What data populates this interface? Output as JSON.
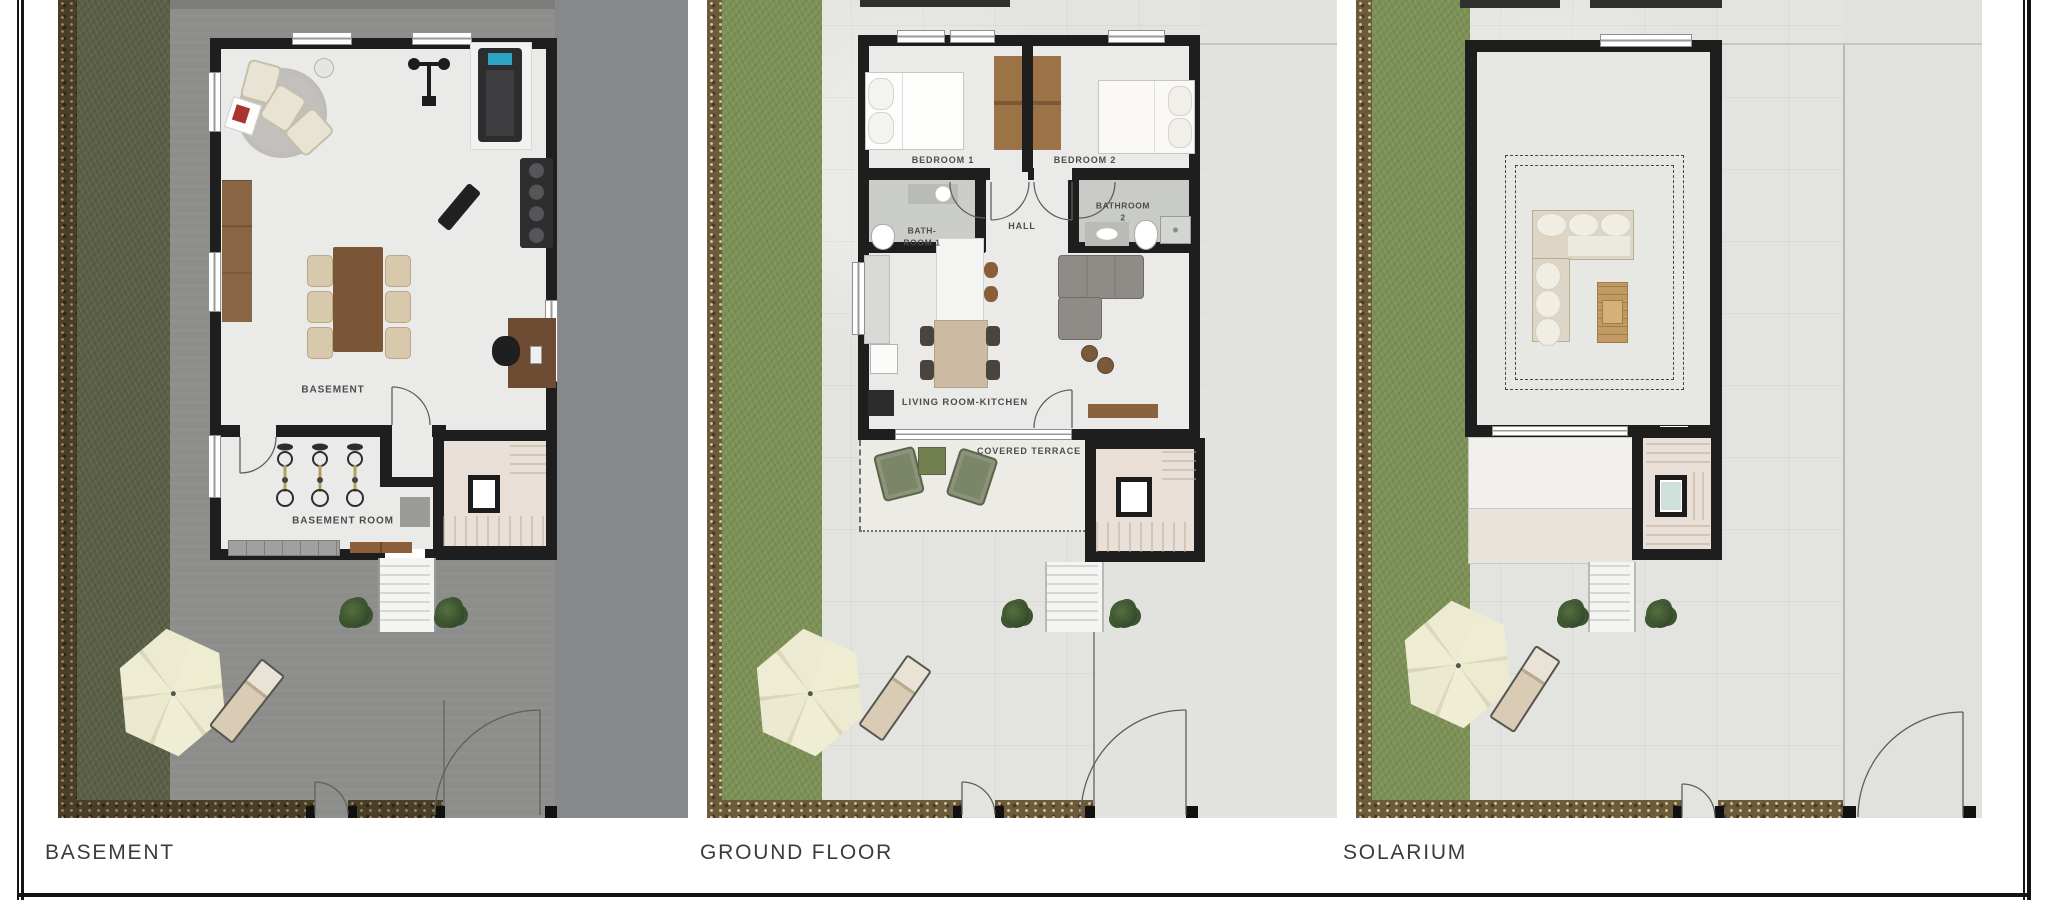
{
  "document": {
    "type": "architectural floor plan sheet",
    "sheet_background": "#ffffff"
  },
  "plans": {
    "basement": {
      "title": "BASEMENT",
      "rooms": {
        "main": "BASEMENT",
        "storage": "BASEMENT ROOM"
      }
    },
    "ground_floor": {
      "title": "GROUND FLOOR",
      "rooms": {
        "bedroom1": "BEDROOM 1",
        "bedroom2": "BEDROOM 2",
        "bath1_l1": "BATH-",
        "bath1_l2": "ROOM 1",
        "bath2_l1": "BATHROOM",
        "bath2_l2": "2",
        "hall": "HALL",
        "living": "LIVING ROOM-KITCHEN",
        "terrace": "COVERED TERRACE"
      }
    },
    "solarium": {
      "title": "SOLARIUM",
      "rooms": {}
    }
  },
  "palette": {
    "wall_black": "#1e1e1e",
    "basement_concrete": "#8d8d8b",
    "basement_garden_grass": "#5a5f45",
    "garden_grass": "#7d9156",
    "dirt_border": "#6b5b39",
    "paving_light": "#e3e3df",
    "interior_floor": "#eaeae8",
    "stairwell_floor": "#e9dfd6",
    "wood_dark": "#7a5538",
    "wood_mid": "#9b7347",
    "chair_beige": "#d8c9ac",
    "parasol_cream": "#edebd0",
    "terrace_chair_green": "#7b8568",
    "treadmill_screen_blue": "#2ba4c4",
    "plant_green": "#3a5230"
  }
}
